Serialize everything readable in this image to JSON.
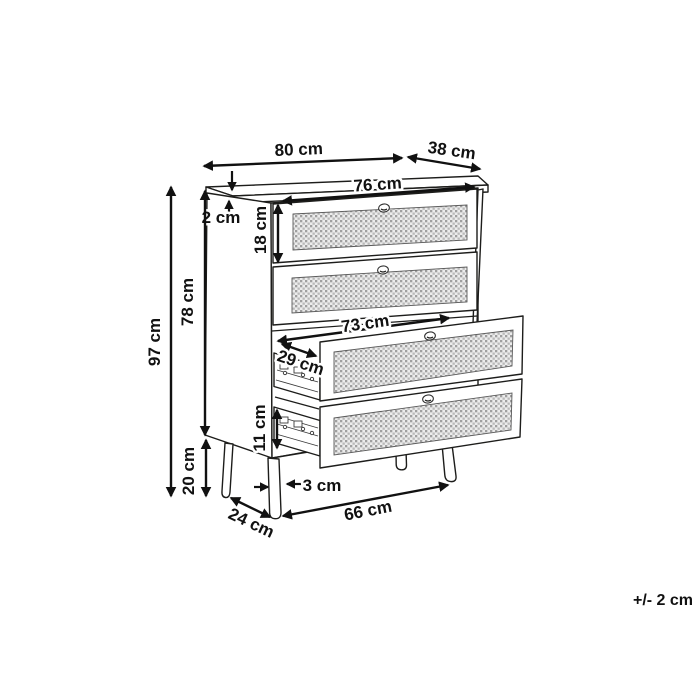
{
  "figure": {
    "kind": "furniture-dimension-diagram",
    "subject": "4-drawer rattan chest of drawers, two bottom drawers shown open",
    "background": "#ffffff",
    "line_color": "#1d1d1b",
    "texture_color": "#a6a6a6"
  },
  "dimensions": {
    "overall_width": "80 cm",
    "overall_depth": "38 cm",
    "top_inner_width": "76 cm",
    "top_thickness": "2 cm",
    "drawer_front_height": "18 cm",
    "total_height": "97 cm",
    "body_height": "78 cm",
    "drawer_inner_width": "73 cm",
    "drawer_inner_depth": "29 cm",
    "drawer_box_height": "11 cm",
    "leg_height": "20 cm",
    "leg_diameter": "3 cm",
    "leg_depth_spacing": "24 cm",
    "leg_width_spacing": "66 cm",
    "tolerance": "+/- 2 cm"
  }
}
